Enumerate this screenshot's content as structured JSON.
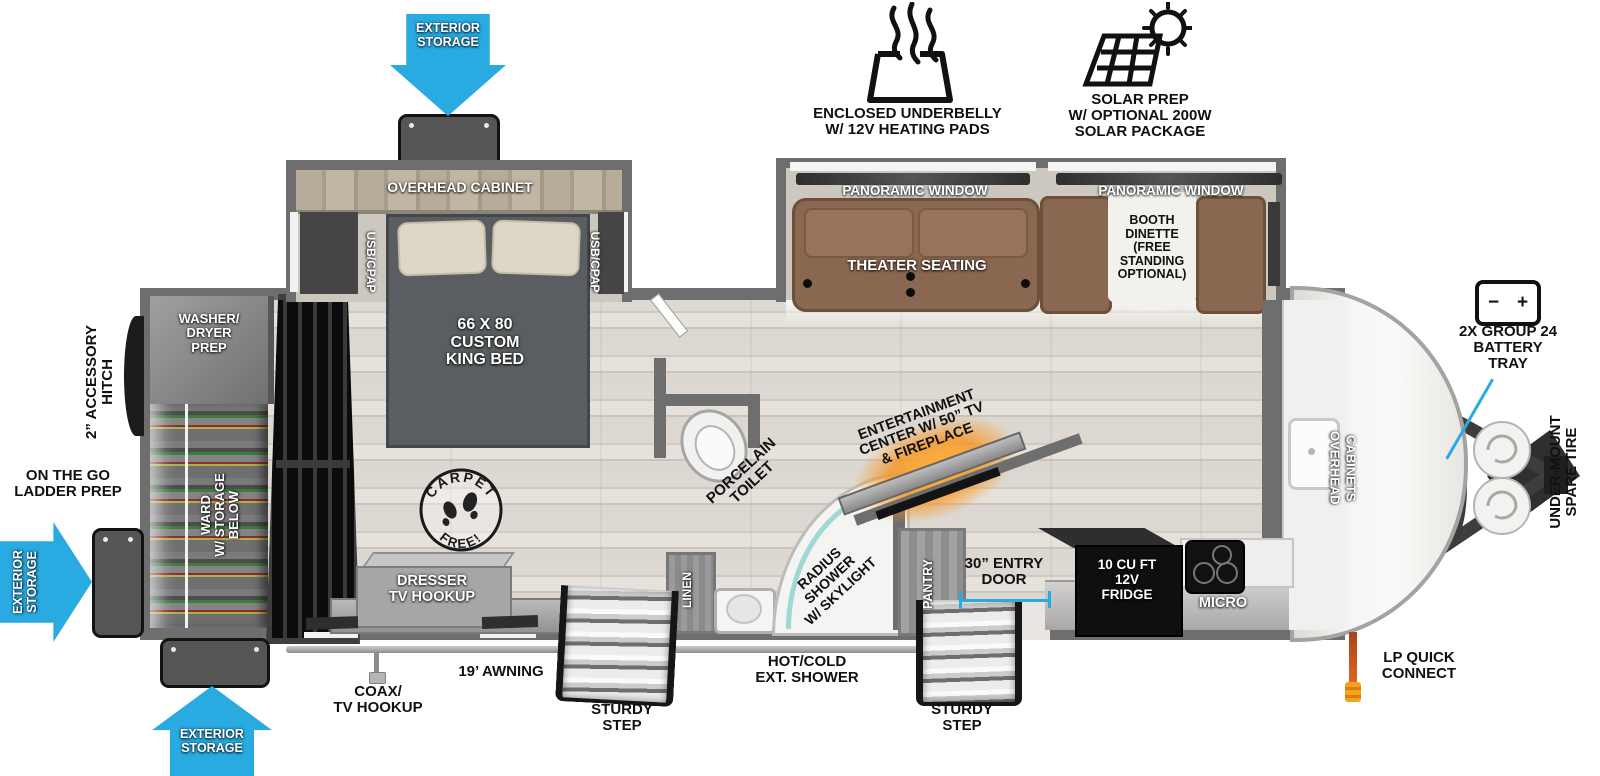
{
  "colors": {
    "accent_blue": "#29abe2",
    "glow_orange": "#f7931e",
    "wall_gray": "#6e6e6e",
    "sofa_brown": "#8a6750"
  },
  "top": {
    "storage_top": "EXTERIOR\nSTORAGE",
    "underbelly": "ENCLOSED UNDERBELLY\nW/ 12V HEATING PADS",
    "solar": "SOLAR PREP\nW/ OPTIONAL 200W\nSOLAR PACKAGE"
  },
  "rear": {
    "hitch": "2” ACCESSORY\nHITCH",
    "ladder": "ON THE GO\nLADDER PREP",
    "storage_left": "EXTERIOR\nSTORAGE",
    "storage_bottom": "EXTERIOR\nSTORAGE",
    "washer": "WASHER/\nDRYER\nPREP",
    "ward": "WARD\nW/ STORAGE\nBELOW"
  },
  "bedroom": {
    "cabinet": "OVERHEAD CABINET",
    "usb_left": "USB/CPAP",
    "usb_right": "USB/CPAP",
    "bed": "66 X 80\nCUSTOM\nKING BED",
    "dresser": "DRESSER\nTV HOOKUP"
  },
  "living": {
    "pano_left": "PANORAMIC WINDOW",
    "pano_right": "PANORAMIC WINDOW",
    "theater": "THEATER SEATING",
    "dinette": "BOOTH\nDINETTE\n(FREE\nSTANDING\nOPTIONAL)",
    "entertainment": "ENTERTAINMENT\nCENTER W/ 50” TV\n& FIREPLACE"
  },
  "bath": {
    "toilet": "PORCELAIN\nTOILET",
    "linen": "LINEN",
    "shower": "RADIUS\nSHOWER\nW/ SKYLIGHT",
    "pantry": "PANTRY"
  },
  "kitchen": {
    "fridge": "10 CU FT\n12V\nFRIDGE",
    "micro": "MICRO",
    "cabinets": "OVERHEAD\nCABINETS",
    "entry": "30” ENTRY\nDOOR"
  },
  "bottom": {
    "awning": "19’ AWNING",
    "coax": "COAX/\nTV HOOKUP",
    "step_left": "STURDY\nSTEP",
    "ext_shower": "HOT/COLD\nEXT. SHOWER",
    "step_right": "STURDY\nSTEP",
    "lp": "LP QUICK\nCONNECT"
  },
  "front": {
    "battery": "2X GROUP 24\nBATTERY\nTRAY",
    "battery_minus": "−",
    "battery_plus": "+",
    "spare": "UNDER-MOUNT\nSPARE TIRE"
  },
  "stamp": {
    "carpet": "CARPET",
    "free": "FREE!"
  }
}
